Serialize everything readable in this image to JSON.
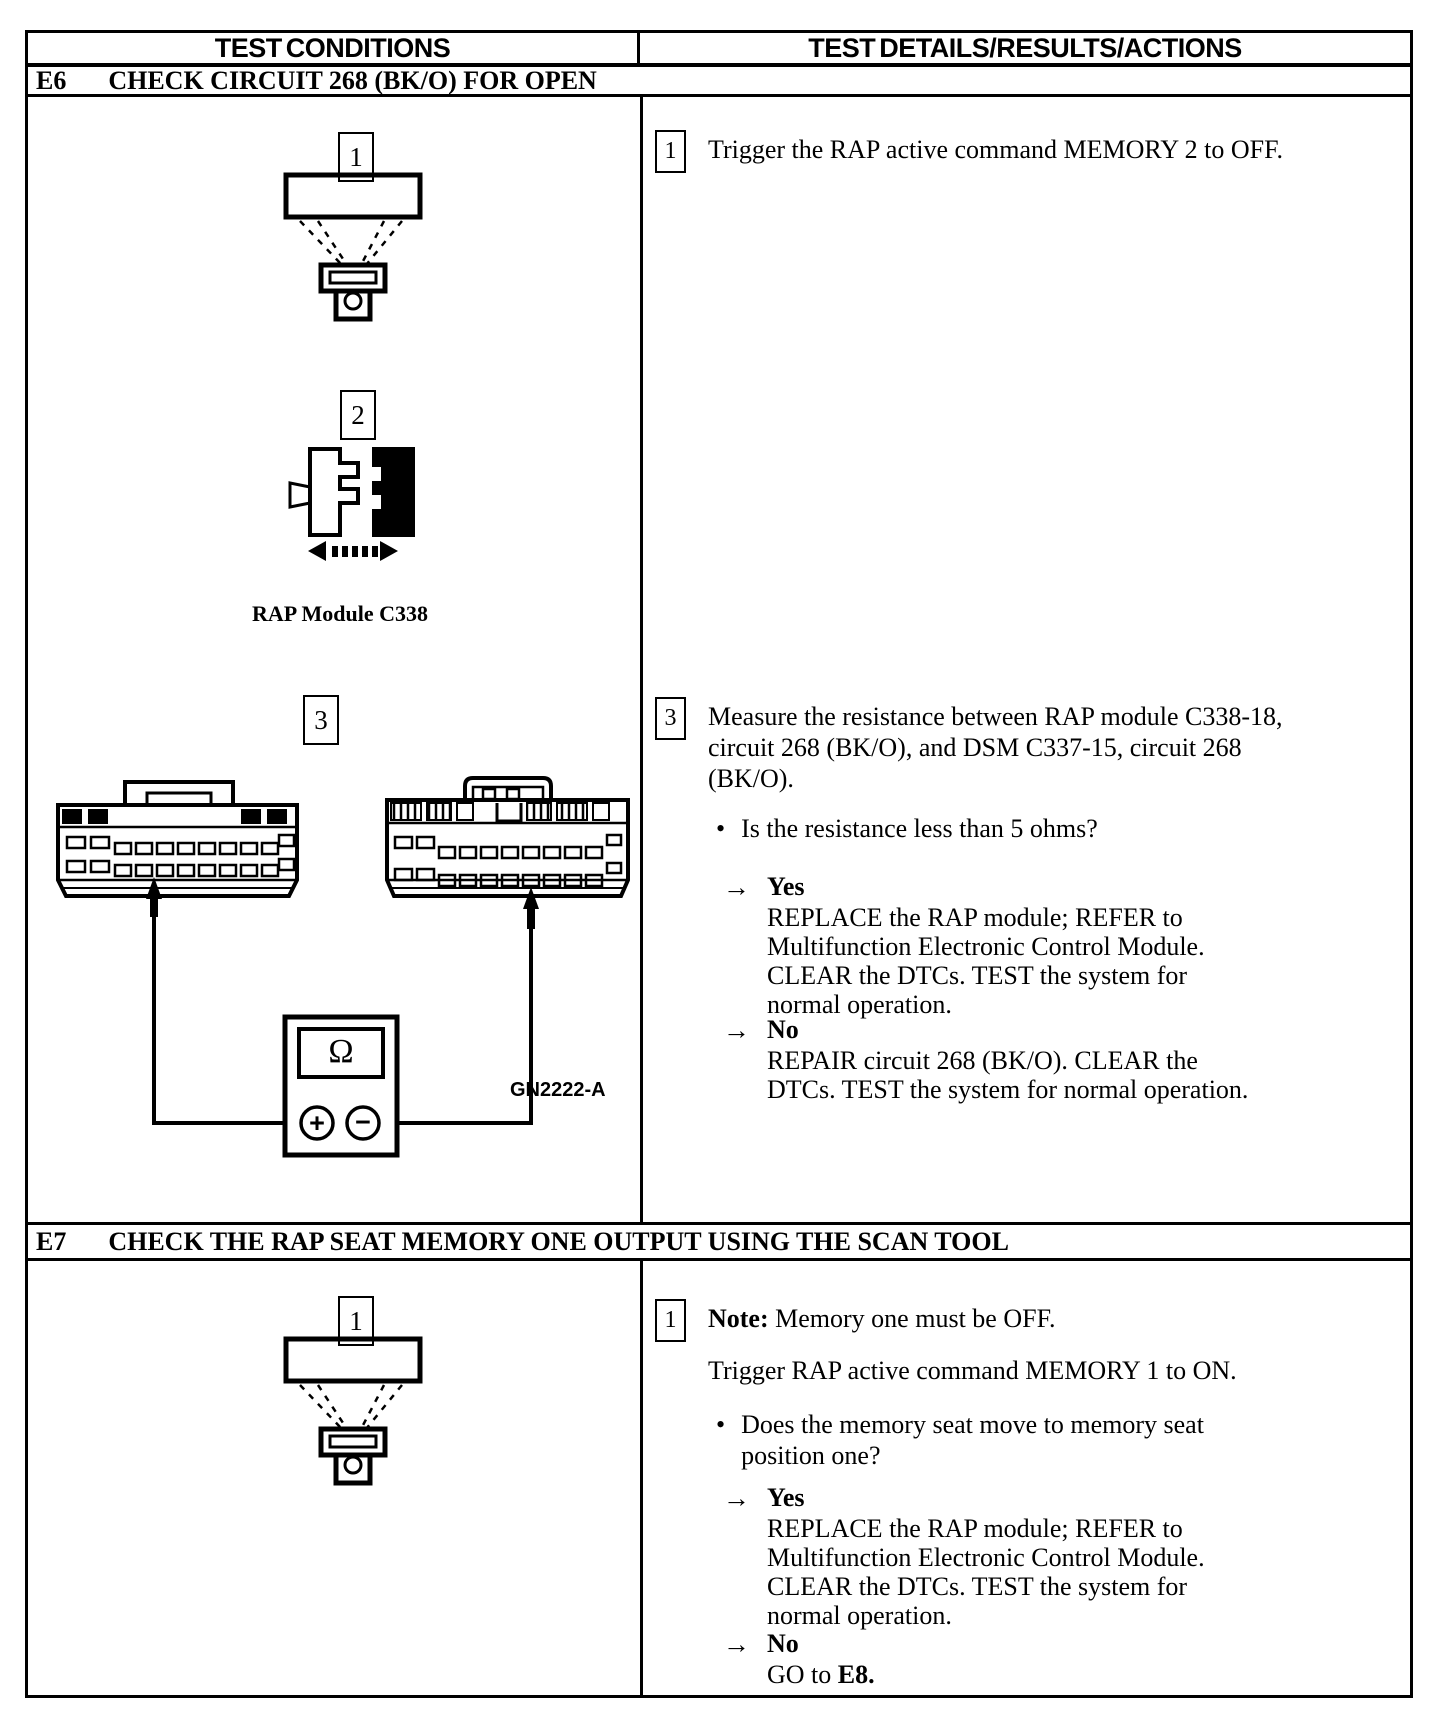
{
  "header": {
    "col_conditions": "TEST CONDITIONS",
    "col_details": "TEST DETAILS/RESULTS/ACTIONS"
  },
  "symbols": {
    "bullet": "•",
    "arrow": "→"
  },
  "e6": {
    "id": "E6",
    "title": "CHECK CIRCUIT 268 (BK/O) FOR OPEN",
    "left": {
      "step1_marker": "1",
      "step2_marker": "2",
      "step3_marker": "3",
      "module_caption": "RAP Module C338",
      "figure_id": "GN2222-A",
      "meter_display": "Ω",
      "meter_plus": "+",
      "meter_minus": "−"
    },
    "right": {
      "step1_marker": "1",
      "step1_text": "Trigger the RAP active command MEMORY 2 to OFF.",
      "step3_marker": "3",
      "step3_text": "Measure the resistance between RAP module C338-18, circuit 268 (BK/O), and DSM C337-15, circuit 268 (BK/O).",
      "question": "Is the resistance less than 5 ohms?",
      "yes_label": "Yes",
      "yes_action": "REPLACE the RAP module; REFER to Multifunction Electronic Control Module. CLEAR the DTCs. TEST the system for normal operation.",
      "no_label": "No",
      "no_action": "REPAIR circuit 268 (BK/O). CLEAR the DTCs. TEST the system for normal operation."
    }
  },
  "e7": {
    "id": "E7",
    "title": "CHECK THE RAP SEAT MEMORY ONE OUTPUT USING THE SCAN TOOL",
    "left": {
      "step1_marker": "1"
    },
    "right": {
      "step1_marker": "1",
      "note_label": "Note:",
      "note_text": " Memory one must be OFF.",
      "step1_text": "Trigger RAP active command MEMORY 1 to ON.",
      "question": "Does the memory seat move to memory seat position one?",
      "yes_label": "Yes",
      "yes_action": "REPLACE the RAP module; REFER to Multifunction Electronic Control Module. CLEAR the DTCs. TEST the system for normal operation.",
      "no_label": "No",
      "no_action_prefix": "GO to ",
      "no_action_target": "E8."
    }
  }
}
